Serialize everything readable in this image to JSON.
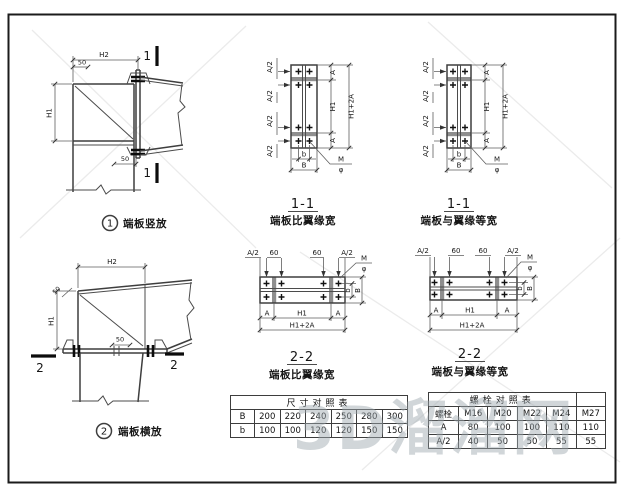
{
  "watermark": {
    "text": "3D溜溜网"
  },
  "dims": {
    "H1": "H1",
    "H2": "H2",
    "H1_2A": "H1+2A",
    "A": "A",
    "A2": "A/2",
    "b": "b",
    "B": "B",
    "n50": "50",
    "n60": "60",
    "M": "M",
    "phi": "φ"
  },
  "sections": {
    "detail1": {
      "num": "1",
      "mark": "1",
      "title": "端板竖放"
    },
    "detail2": {
      "num": "2",
      "mark": "2",
      "title": "端板横放"
    },
    "sec11_wide": {
      "name": "1-1",
      "caption": "端板比翼缘宽"
    },
    "sec11_equal": {
      "name": "1-1",
      "caption": "端板与翼缘等宽"
    },
    "sec22_wide": {
      "name": "2-2",
      "caption": "端板比翼缘宽"
    },
    "sec22_equal": {
      "name": "2-2",
      "caption": "端板与翼缘等宽"
    }
  },
  "tables": {
    "size": {
      "title": "尺寸对照表",
      "rows": [
        {
          "label": "B",
          "values": [
            "200",
            "220",
            "240",
            "250",
            "280",
            "300"
          ]
        },
        {
          "label": "b",
          "values": [
            "100",
            "100",
            "120",
            "120",
            "150",
            "150"
          ]
        }
      ]
    },
    "bolt": {
      "title": "螺栓对照表",
      "header": {
        "label": "螺栓",
        "values": [
          "M16",
          "M20",
          "M22",
          "M24",
          "M27"
        ]
      },
      "rows": [
        {
          "label": "A",
          "values": [
            "80",
            "100",
            "100",
            "110",
            "110"
          ]
        },
        {
          "label": "A/2",
          "values": [
            "40",
            "50",
            "50",
            "55",
            "55"
          ]
        }
      ]
    }
  }
}
